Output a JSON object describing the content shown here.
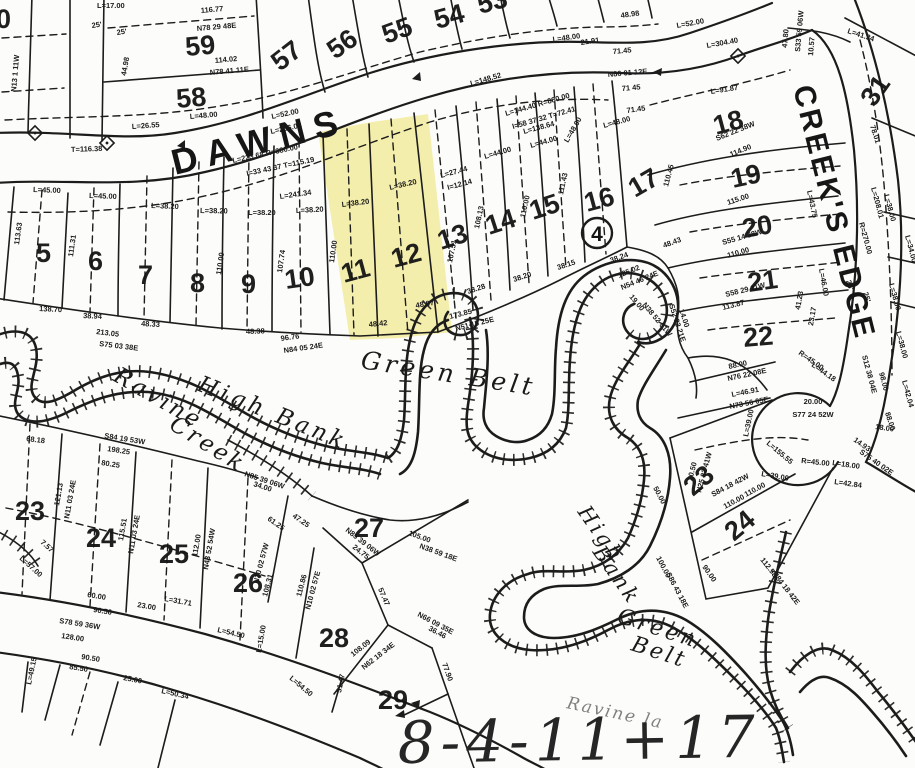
{
  "note": {
    "handwritten": "8-4-11+17"
  },
  "streets": {
    "dawns": "DAWNS",
    "creeks_edge": "CREEK'S EDGE"
  },
  "areas": {
    "green_belt_1": "Green Belt",
    "high_bank_1": "High Bank",
    "ravine_1": "Ravine",
    "ravine_2": "Creek",
    "high_bank_2a": "High",
    "high_bank_2b": "Bank",
    "green_belt_2a": "Green",
    "green_belt_2b": "Belt",
    "ravine_partial": "Ravine la"
  },
  "markers": {
    "circle_note": "4",
    "edge_lot_fragment": "0"
  },
  "highlight": {
    "color": "#f5ee9c",
    "lots": "11, 12"
  },
  "lots": [
    "59",
    "58",
    "57",
    "56",
    "55",
    "54",
    "53",
    "5",
    "6",
    "7",
    "8",
    "9",
    "10",
    "11",
    "12",
    "13",
    "14",
    "15",
    "16",
    "17",
    "18",
    "19",
    "20",
    "21",
    "22",
    "31",
    "23",
    "24",
    "25",
    "26",
    "27",
    "28",
    "29",
    "23",
    "24"
  ],
  "dims": [
    "L=17.00",
    "25'",
    "25'",
    "N13 1 11W",
    "44.98",
    "116.77",
    "N78 29 48E",
    "114.02",
    "N78 41 11E",
    "L=48.00",
    "L=26.55",
    "L=206.03",
    "L=52.00",
    "T=116.38",
    "L=223.68  R=380.00",
    "I=33 43 37  T=115.19",
    "L=241.34",
    "L=45.00",
    "L=45.00",
    "L=38.20",
    "L=38.20",
    "L=38.20",
    "L=38.20",
    "L=38.20",
    "L=38.20",
    "L=27.44",
    "I=12.14",
    "L=44.00",
    "L=44.00",
    "L=48.00",
    "L=48.00",
    "71.45",
    "71 45",
    "N86 01 12E",
    "71.45",
    "48.98",
    "21.91",
    "L=48.00",
    "L=52.00",
    "L=144.40  R=880.00",
    "I=58 37 32  T=72.41",
    "L=148.52",
    "L=138.64",
    "L=304.40",
    "L=91.87",
    "47.80",
    "S33 59 06W",
    "10.57",
    "L=41.34",
    "78.01",
    "L=208.01",
    "R=270.00",
    "25'",
    "25'",
    "L=38.00",
    "L=34.00",
    "L=38.00",
    "L=38.00",
    "L=42.04",
    "98.00",
    "S12 38 04E",
    "88.00",
    "88.00",
    "N76 22 08E",
    "L=46.91",
    "N73 56 05E",
    "114.90",
    "S62 22 38W",
    "115.00",
    "S55 14 38W",
    "110.00",
    "S58 29 11W",
    "113.87",
    "L=43.75",
    "L=46.00",
    "48.43",
    "38.24",
    "125.02",
    "N54 46 24E",
    "19.00",
    "N38 52 01W",
    "S52 23 21E",
    "14.00",
    "38.28",
    "38.20",
    "38.15",
    "173.85",
    "N51 15 25E",
    "48.07",
    "48.42",
    "48.38",
    "96.76",
    "N84 05 24E",
    "48.33",
    "38.94",
    "138.70",
    "213.05",
    "S75 03 38E",
    "107.51",
    "110.00",
    "108.13",
    "110.00",
    "111.43",
    "110.45",
    "110.00",
    "107.74",
    "113.63",
    "111.31",
    "20.00",
    "S77 24 52W",
    "R=45.00",
    "L=39.00",
    "L=39.00",
    "L=155.55",
    "L=42.84",
    "41.23",
    "23.17",
    "R=45.00",
    "L=44.18",
    "14.93",
    "S75 40 02E",
    "18.00",
    "L=18.00",
    "20.50",
    "N25 22 41W",
    "S84 18 42W",
    "110.00",
    "110.00",
    "50.00",
    "100.00",
    "S86 43 18E",
    "90.00",
    "112.53",
    "N84 18 42E",
    "S84 19 53W",
    "198.25",
    "80.25",
    "68.18",
    "60.00",
    "90.50",
    "23.00",
    "L=31.71",
    "L=54.50",
    "L=15.00",
    "L=54.50",
    "S78 59 36W",
    "128.00",
    "121.13",
    "N11 03 24E",
    "115.51",
    "N11 03 24E",
    "112.00",
    "N43 52 54W",
    "N10 02 57W",
    "108.31",
    "110.86",
    "N10 02 57E",
    "61.25",
    "47.25",
    "34.00",
    "N85 39 06W",
    "N85 39 06W",
    "24.75",
    "105.00",
    "N38 59 18E",
    "57.47",
    "N66 09 35E",
    "36.46",
    "108.09",
    "N62 18 34E",
    "77.90",
    "31.47",
    "90.50",
    "85.50",
    "25.00",
    "L=50.34",
    "L=49.15",
    "L=57.00",
    "7.57"
  ]
}
